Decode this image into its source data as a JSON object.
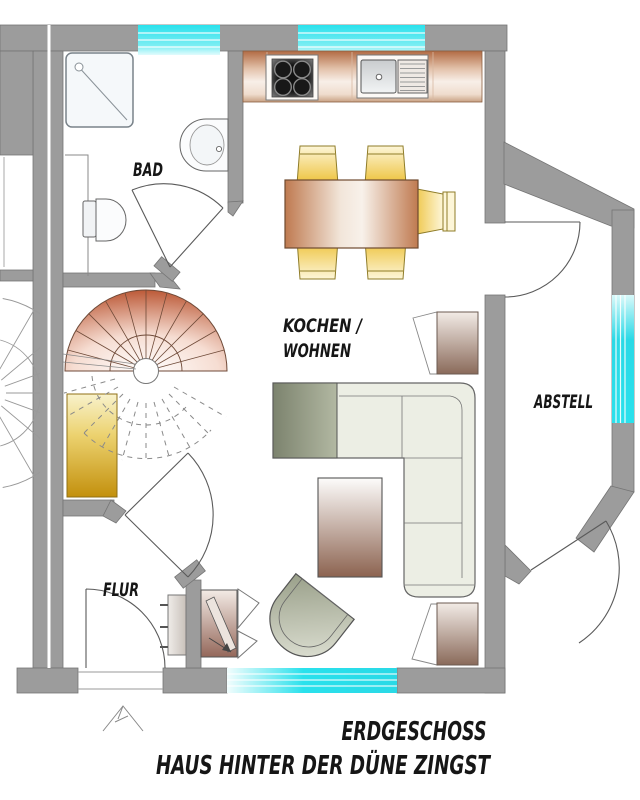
{
  "floor_plan": {
    "title": {
      "line1": "ERDGESCHOSS",
      "line2": "HAUS HINTER DER DÜNE ZINGST"
    },
    "rooms": {
      "bad": "BAD",
      "kochen_wohnen_line1": "KOCHEN /",
      "kochen_wohnen_line2": "WOHNEN",
      "abstell": "ABSTELL",
      "flur": "FLUR"
    },
    "colors": {
      "wall_gray": "#9c9c9c",
      "window_glass_cyan": "#2ae1ec",
      "counter_copper": "#b26b44",
      "chair_yellow": "#edc139",
      "cabinet_gold": "#c3900d",
      "stair_copper": "#bc5a38",
      "sofa_sage": "#eceee4",
      "armchair_brown": "#8a6a5a",
      "line_gray": "#5a5a5a",
      "text_black": "#161616"
    }
  }
}
